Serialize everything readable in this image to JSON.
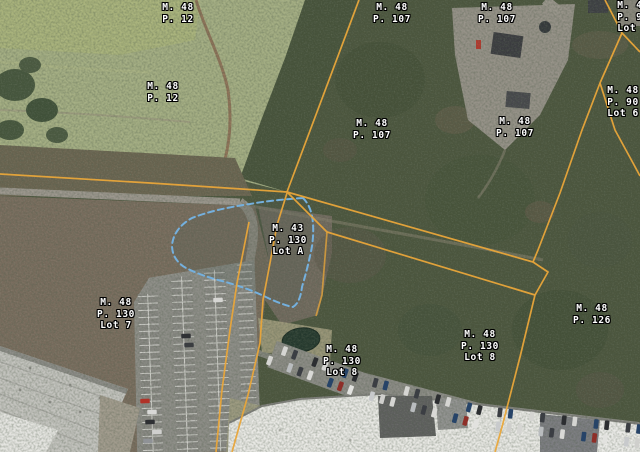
{
  "map": {
    "type": "aerial-parcel-map",
    "parcel_line_color": "#e9a63a",
    "delineation_line_color": "#74b0de",
    "label_color": "#ffffff",
    "labels": [
      {
        "text": "M. 48\nP. 12",
        "x": 178,
        "y": 2
      },
      {
        "text": "M. 48\nP. 12",
        "x": 163,
        "y": 81
      },
      {
        "text": "M. 48\nP. 107",
        "x": 392,
        "y": 2
      },
      {
        "text": "M. 48\nP. 107",
        "x": 372,
        "y": 118
      },
      {
        "text": "M. 48\nP. 107",
        "x": 497,
        "y": 2
      },
      {
        "text": "M. 48\nP. 107",
        "x": 515,
        "y": 116
      },
      {
        "text": "M. 48\nP. 90\nLot 5",
        "x": 633,
        "y": 0
      },
      {
        "text": "M. 48\nP. 90\nLot 6",
        "x": 623,
        "y": 85
      },
      {
        "text": "M. 43\nP. 130\nLot A",
        "x": 288,
        "y": 223
      },
      {
        "text": "M. 48\nP. 130\nLot 7",
        "x": 116,
        "y": 297
      },
      {
        "text": "M. 48\nP. 130\nLot 8",
        "x": 342,
        "y": 344
      },
      {
        "text": "M. 48\nP. 130\nLot 8",
        "x": 480,
        "y": 329
      },
      {
        "text": "M. 48\nP. 126",
        "x": 592,
        "y": 303
      }
    ]
  }
}
